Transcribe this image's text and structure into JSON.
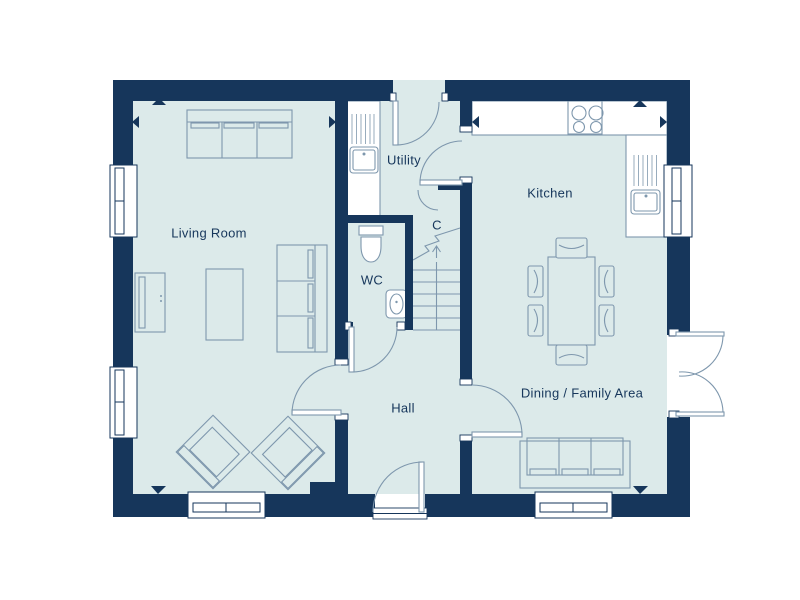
{
  "rooms": {
    "living_room": {
      "label": "Living Room"
    },
    "utility": {
      "label": "Utility"
    },
    "kitchen": {
      "label": "Kitchen"
    },
    "wc": {
      "label": "WC"
    },
    "cupboard": {
      "label": "C"
    },
    "hall": {
      "label": "Hall"
    },
    "dining": {
      "label": "Dining / Family Area"
    }
  },
  "colors": {
    "wall": "#16365b",
    "floor": "#dceaea",
    "furniture_line": "#7e97ad",
    "fixture_fill": "#ffffff",
    "label_text": "#16365b",
    "background": "#ffffff"
  },
  "fixtures": {
    "icon_names": [
      "window",
      "door-swing",
      "french-doors",
      "stairs-up-arrow",
      "stairs-break-line",
      "toilet",
      "wash-basin",
      "utility-sink",
      "kitchen-sink",
      "hob",
      "sofa-three-seat",
      "side-sofa",
      "dining-sofa",
      "armchair",
      "coffee-table",
      "tv-unit",
      "dining-table",
      "dining-chair",
      "dimension-arrow"
    ]
  }
}
